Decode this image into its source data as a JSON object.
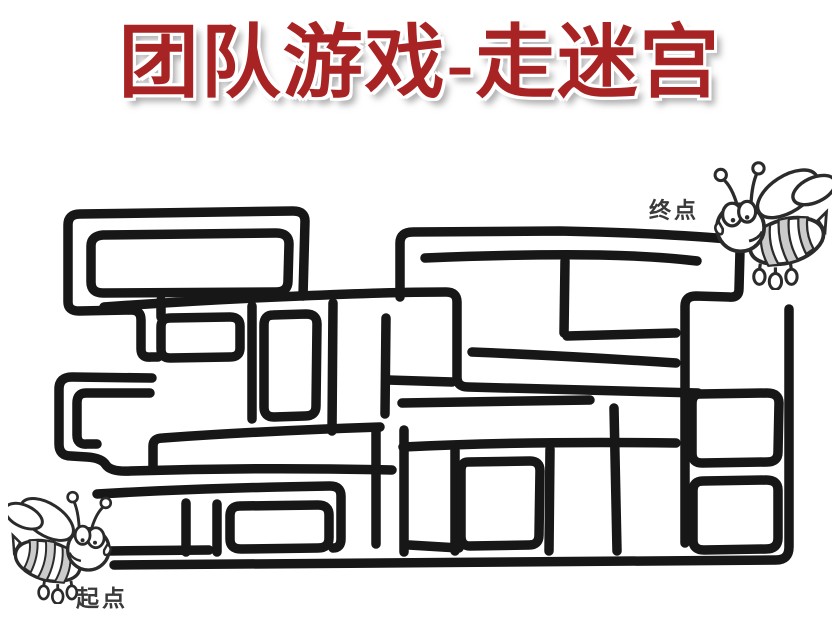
{
  "title": {
    "text": "团队游戏-走迷宫",
    "color": "#a82424"
  },
  "markers": {
    "start_label": "起点",
    "end_label": "终点",
    "label_color": "#3a3a3a"
  },
  "bee": {
    "outline_color": "#2b2b2b",
    "stripe_color": "#cbcbcb"
  },
  "maze": {
    "wall_color": "#171717",
    "wall_width": 9.5,
    "walls": [
      "M303,296 L305,221 Q305,211 293,211 L80,214 Q68,214 68,225 L68,302 Q68,311 79,311 L131,310 Q141,310 141,320 L141,349 Q141,358 151,357 L158,357",
      "M103,235 L276,233 Q289,233 289,244 L288,281 Q288,292 276,292 L103,293 Q91,293 91,282 L91,246 Q91,236 103,235 Z",
      "M104,307 Q200,300 300,296 Q390,292 446,292 Q457,292 457,302 L457,377 Q457,387 468,387 L698,393",
      "M161,300 L161,317",
      "M170,318 L230,317 Q240,317 240,326 L240,348 Q240,357 230,357 L170,358 Q161,358 161,349 L161,327 Q161,318 170,318 Z",
      "M152,378 L72,377 Q59,377 59,389 L59,444 Q59,456 71,456 L87,457 Q102,458 106,465 Q111,472 130,471 Q260,467 392,470",
      "M150,393 L86,393 Q77,393 77,403 L77,435 Q77,445 87,444 L97,444",
      "M252,306 L252,419",
      "M273,315 L306,314 Q317,314 317,324 L316,406 Q316,416 305,416 L274,417 Q264,417 264,407 L264,325 Q264,315 273,315 Z",
      "M333,303 L332,431",
      "M386,318 L385,414",
      "M153,470 L153,446 Q153,438 163,438 Q260,431 380,427",
      "M388,380 L452,382",
      "M400,297 L400,243 Q400,232 413,232 L560,231 Q660,233 728,239 Q740,241 740,251 L739,289 Q739,298 729,297 L696,296 Q685,296 685,306 L685,543",
      "M425,258 Q520,254 600,255 Q655,256 697,261",
      "M565,261 L564,333",
      "M567,336 L676,333",
      "M472,352 Q570,356 676,363",
      "M402,403 L590,400",
      "M403,447 Q520,441 676,443",
      "M455,450 L455,551",
      "M409,545 L459,548",
      "M404,430 L404,552",
      "M376,430 L376,544",
      "M97,494 Q200,488 330,486 Q341,486 341,496 L341,539 Q341,548 333,548",
      "M107,551 L209,550",
      "M217,504 L217,552",
      "M240,506 L318,505 Q329,505 329,515 L329,538 Q329,548 318,548 L241,549 Q230,549 230,539 L230,516 Q230,506 240,506 Z",
      "M186,503 L186,552",
      "M550,449 L549,551",
      "M468,462 L530,461 Q540,461 540,471 L539,535 Q539,545 529,545 L470,546 Q461,546 461,536 L461,471 Q461,462 468,462 Z",
      "M700,394 L767,393 Q779,393 779,403 L778,452 Q778,462 767,462 L702,463 Q692,463 692,453 L692,404 Q692,394 700,394 Z",
      "M703,481 L766,480 Q778,480 778,490 L778,538 Q778,549 766,549 L704,550 Q693,550 693,540 L693,491 Q693,481 703,481 Z",
      "M789,309 L789,547 Q789,560 776,560 Q400,564 114,565",
      "M614,408 L617,551"
    ]
  }
}
